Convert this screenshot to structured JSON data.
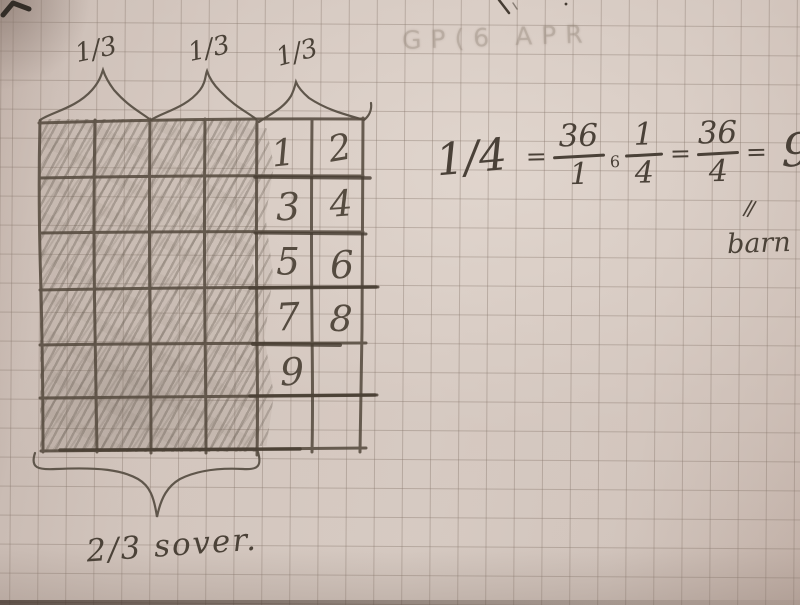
{
  "diagram": {
    "third_labels": [
      "1/3",
      "1/3",
      "1/3"
    ],
    "grid": {
      "rows": 6,
      "cols": 6,
      "shaded_columns": 4
    },
    "cell_numbers": [
      "1",
      "2",
      "3",
      "4",
      "5",
      "6",
      "7",
      "8",
      "9"
    ],
    "bottom_label": "2/3 sover."
  },
  "equation": {
    "lead": "1/4",
    "eq1": "=",
    "frac1": {
      "num": "36",
      "den": "1"
    },
    "operator": "6",
    "frac2": {
      "num": "1",
      "den": "4"
    },
    "eq2": "=",
    "frac3": {
      "num": "36",
      "den": "4"
    },
    "eq3": "=",
    "result": "9",
    "arrow_marks": "//",
    "annotation": "barn"
  },
  "stray_marks": {
    "ghost_text": "GP(6  APR"
  },
  "colors": {
    "paper": "#d3c6be",
    "graph_line": "#86766b",
    "pencil": "#4a4138",
    "photo_edge": "#3a2d25"
  }
}
